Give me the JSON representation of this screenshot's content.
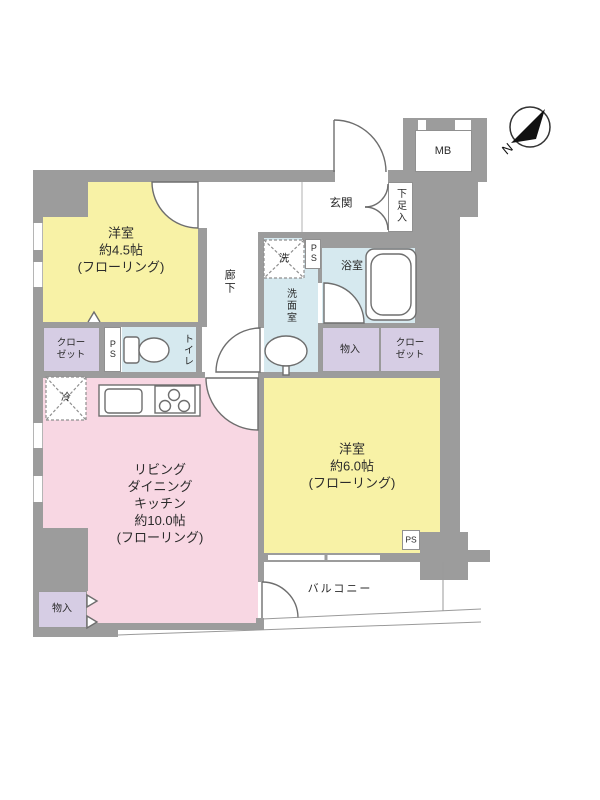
{
  "compass": {
    "label": "N"
  },
  "rooms": {
    "bedroom_45": {
      "label": "洋室\n約4.5帖\n(フローリング)"
    },
    "bedroom_60": {
      "label": "洋室\n約6.0帖\n(フローリング)"
    },
    "ldk": {
      "label": "リビング\nダイニング\nキッチン\n約10.0帖\n(フローリング)"
    },
    "corridor": {
      "label": "廊下"
    },
    "entrance": {
      "label": "玄関"
    },
    "shoe_storage": {
      "label": "下足入"
    },
    "meter_box": {
      "label": "MB"
    },
    "washroom": {
      "label": "洗面室"
    },
    "bathroom": {
      "label": "浴室"
    },
    "toilet": {
      "label": "トイレ"
    },
    "closet_left": {
      "label": "クロー\nゼット"
    },
    "closet_right": {
      "label": "クロー\nゼット"
    },
    "storage_middle": {
      "label": "物入"
    },
    "storage_bottom": {
      "label": "物入"
    },
    "balcony": {
      "label": "バルコニー"
    }
  },
  "fixtures": {
    "washer": {
      "label": "洗"
    },
    "fridge": {
      "label": "冷"
    },
    "pipe_space_washroom": {
      "label": "PS"
    },
    "pipe_space_toilet": {
      "label": "PS"
    },
    "pipe_space_balcony": {
      "label": "PS"
    }
  },
  "colors": {
    "wall": "#9c9c9c",
    "bedroom_fill": "#f8f2a6",
    "ldk_fill": "#f8d7e3",
    "wet_area_fill": "#d6e9ef",
    "storage_fill": "#d6cde4"
  }
}
